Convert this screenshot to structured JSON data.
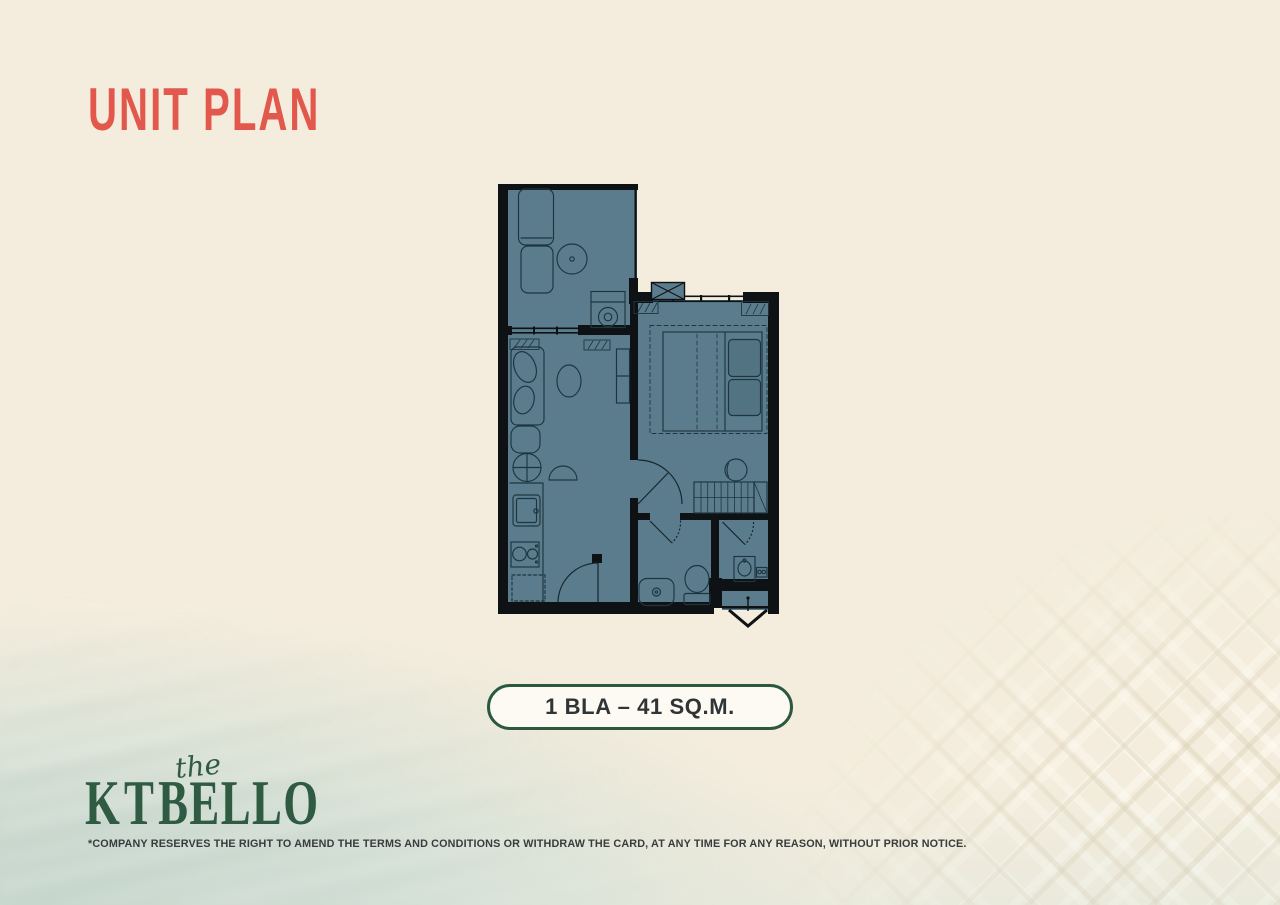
{
  "title": "UNIT PLAN",
  "badge": {
    "label": "1 BLA – 41 SQ.M."
  },
  "logo": {
    "script_word": "the",
    "letter_k": "K",
    "letter_t": "T",
    "letters_bello": "BELLO"
  },
  "disclaimer": "*COMPANY RESERVES THE RIGHT TO AMEND THE TERMS AND CONDITIONS OR WITHDRAW THE CARD, AT ANY TIME FOR ANY REASON, WITHOUT PRIOR NOTICE.",
  "colors": {
    "background_cream": "#F4EDDD",
    "accent_coral": "#E2584D",
    "brand_green": "#2F5B42",
    "plan_room_teal": "#5A7C8C",
    "plan_wall_black": "#0F1215",
    "plan_line": "#1E3541",
    "badge_border_green": "#2C5840",
    "badge_fill": "#FCFAF2",
    "badge_text": "#2F3437",
    "disclaimer_text": "#383C3E",
    "surfboard_coral": "#E56A58"
  }
}
